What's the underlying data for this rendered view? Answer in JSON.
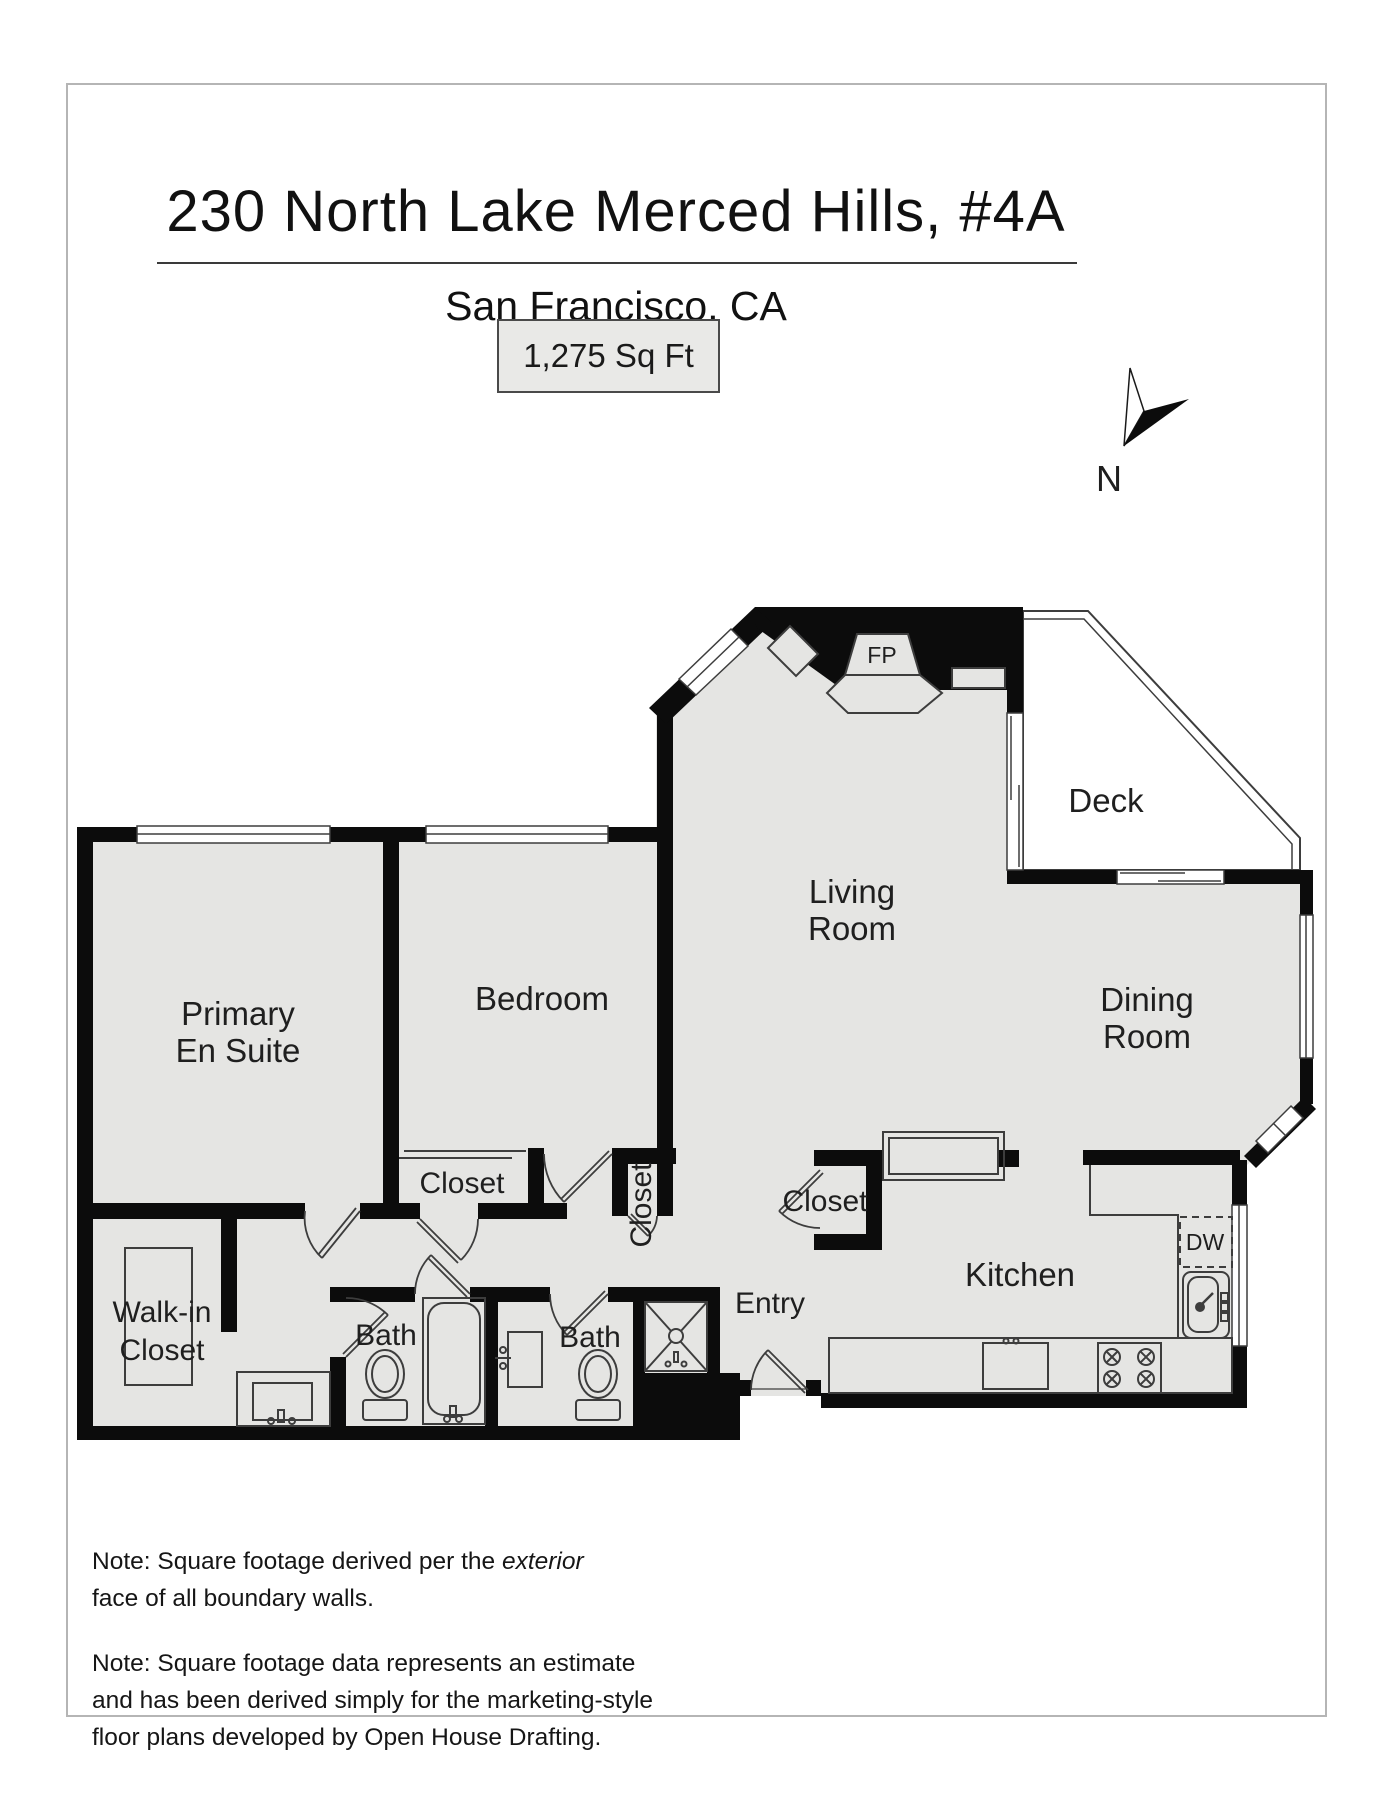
{
  "header": {
    "title": "230 North Lake Merced Hills, #4A",
    "city": "San Francisco, CA",
    "area": "1,275 Sq Ft"
  },
  "compass": {
    "north": "N"
  },
  "plan": {
    "rooms": {
      "primary": {
        "line1": "Primary",
        "line2": "En Suite"
      },
      "bedroom": {
        "label": "Bedroom"
      },
      "living": {
        "line1": "Living",
        "line2": "Room"
      },
      "dining": {
        "line1": "Dining",
        "line2": "Room"
      },
      "deck": {
        "label": "Deck"
      },
      "kitchen": {
        "label": "Kitchen"
      },
      "entry": {
        "label": "Entry"
      },
      "walkin": {
        "line1": "Walk-in",
        "line2": "Closet"
      },
      "bath_primary": {
        "label": "Bath"
      },
      "bath_hall": {
        "label": "Bath"
      },
      "closet_bedroom": {
        "label": "Closet"
      },
      "closet_hall": {
        "label": "Closet"
      },
      "closet_entry": {
        "label": "Closet"
      }
    },
    "fixtures": {
      "fireplace": "FP",
      "dishwasher": "DW"
    }
  },
  "notes": {
    "n1_pre": "Note: Square footage derived per the ",
    "n1_italic": "exterior",
    "n1_line2": "face of all boundary walls.",
    "n2_line1": "Note: Square footage data represents an estimate",
    "n2_line2": "and has been derived simply for the marketing-style",
    "n2_line3": "floor plans developed by Open House Drafting."
  }
}
